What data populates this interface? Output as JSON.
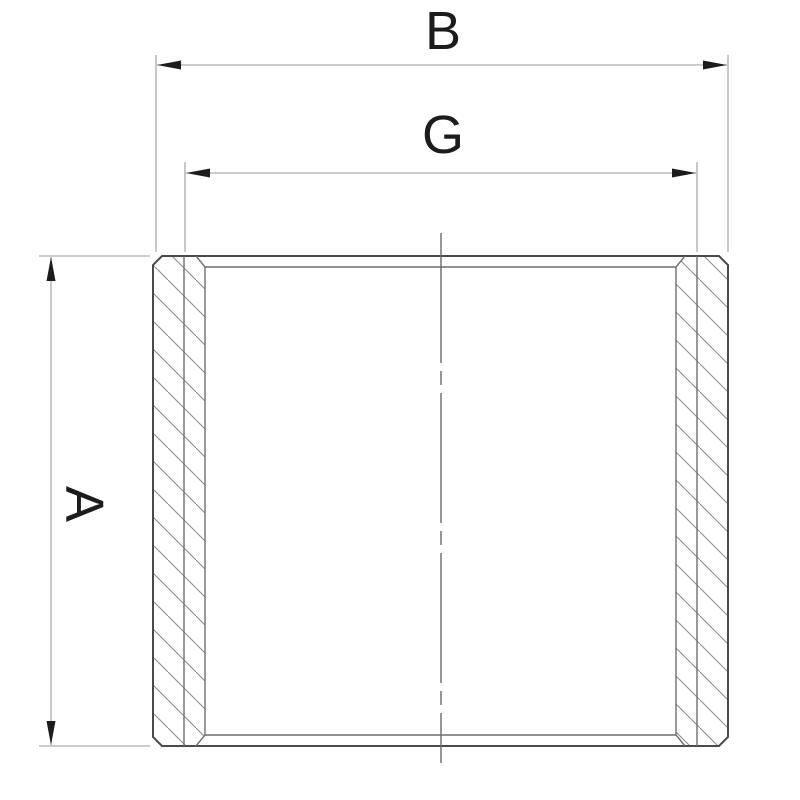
{
  "drawing": {
    "kind": "engineering cross-section of threaded pipe socket with dimension callouts",
    "labels": {
      "overall_width": "B",
      "thread_width": "G",
      "height": "A"
    },
    "colors": {
      "background": "#ffffff",
      "contour": "#4a4a4a",
      "detail": "#6f6f6f",
      "dimension": "#9a9a9a",
      "hatch": "#8a8a8a",
      "centerline": "#6a6a6a",
      "arrow": "#1c1c1c",
      "text": "#1c1c1c"
    }
  }
}
